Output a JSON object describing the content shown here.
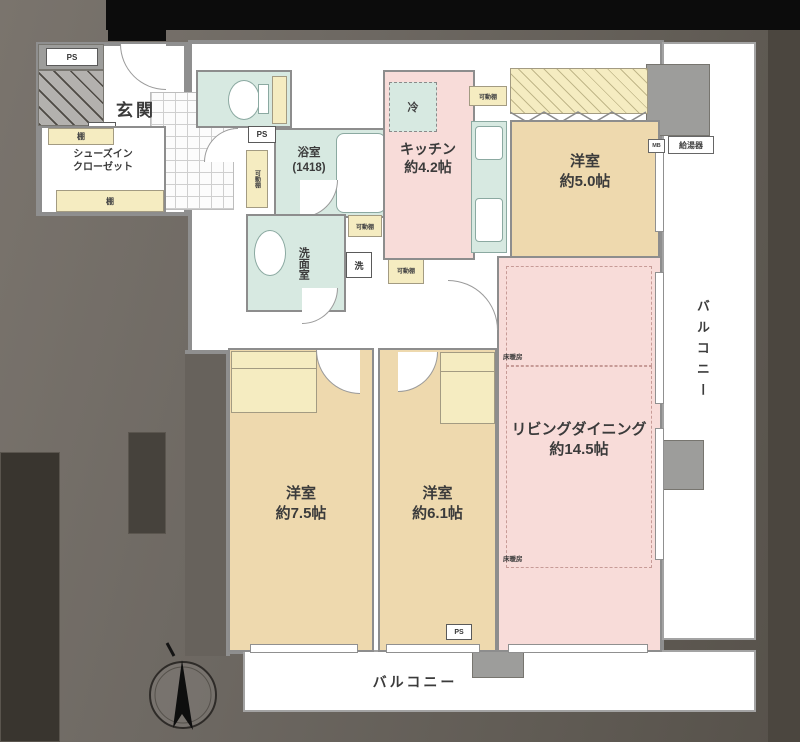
{
  "rooms": {
    "entrance": {
      "name": "玄関"
    },
    "shoe_closet": {
      "name": "シューズイン\nクローゼット"
    },
    "bathroom": {
      "name": "浴室",
      "size": "(1418)"
    },
    "washroom": {
      "name": "洗面室"
    },
    "kitchen": {
      "name": "キッチン",
      "size": "約4.2帖"
    },
    "bedroom_5": {
      "name": "洋室",
      "size": "約5.0帖"
    },
    "living_dining": {
      "name": "リビングダイニング",
      "size": "約14.5帖"
    },
    "bedroom_75": {
      "name": "洋室",
      "size": "約7.5帖"
    },
    "bedroom_61": {
      "name": "洋室",
      "size": "約6.1帖"
    },
    "balcony_right": {
      "name": "バルコニー"
    },
    "balcony_bottom": {
      "name": "バルコニー"
    }
  },
  "labels": {
    "ps": "PS",
    "shelf": "棚",
    "movable_shelf": "可動棚",
    "refrigerator": "冷",
    "washing_machine": "洗",
    "meter_box": "MB",
    "water_heater": "給湯器",
    "floor_heating": "床暖房"
  }
}
